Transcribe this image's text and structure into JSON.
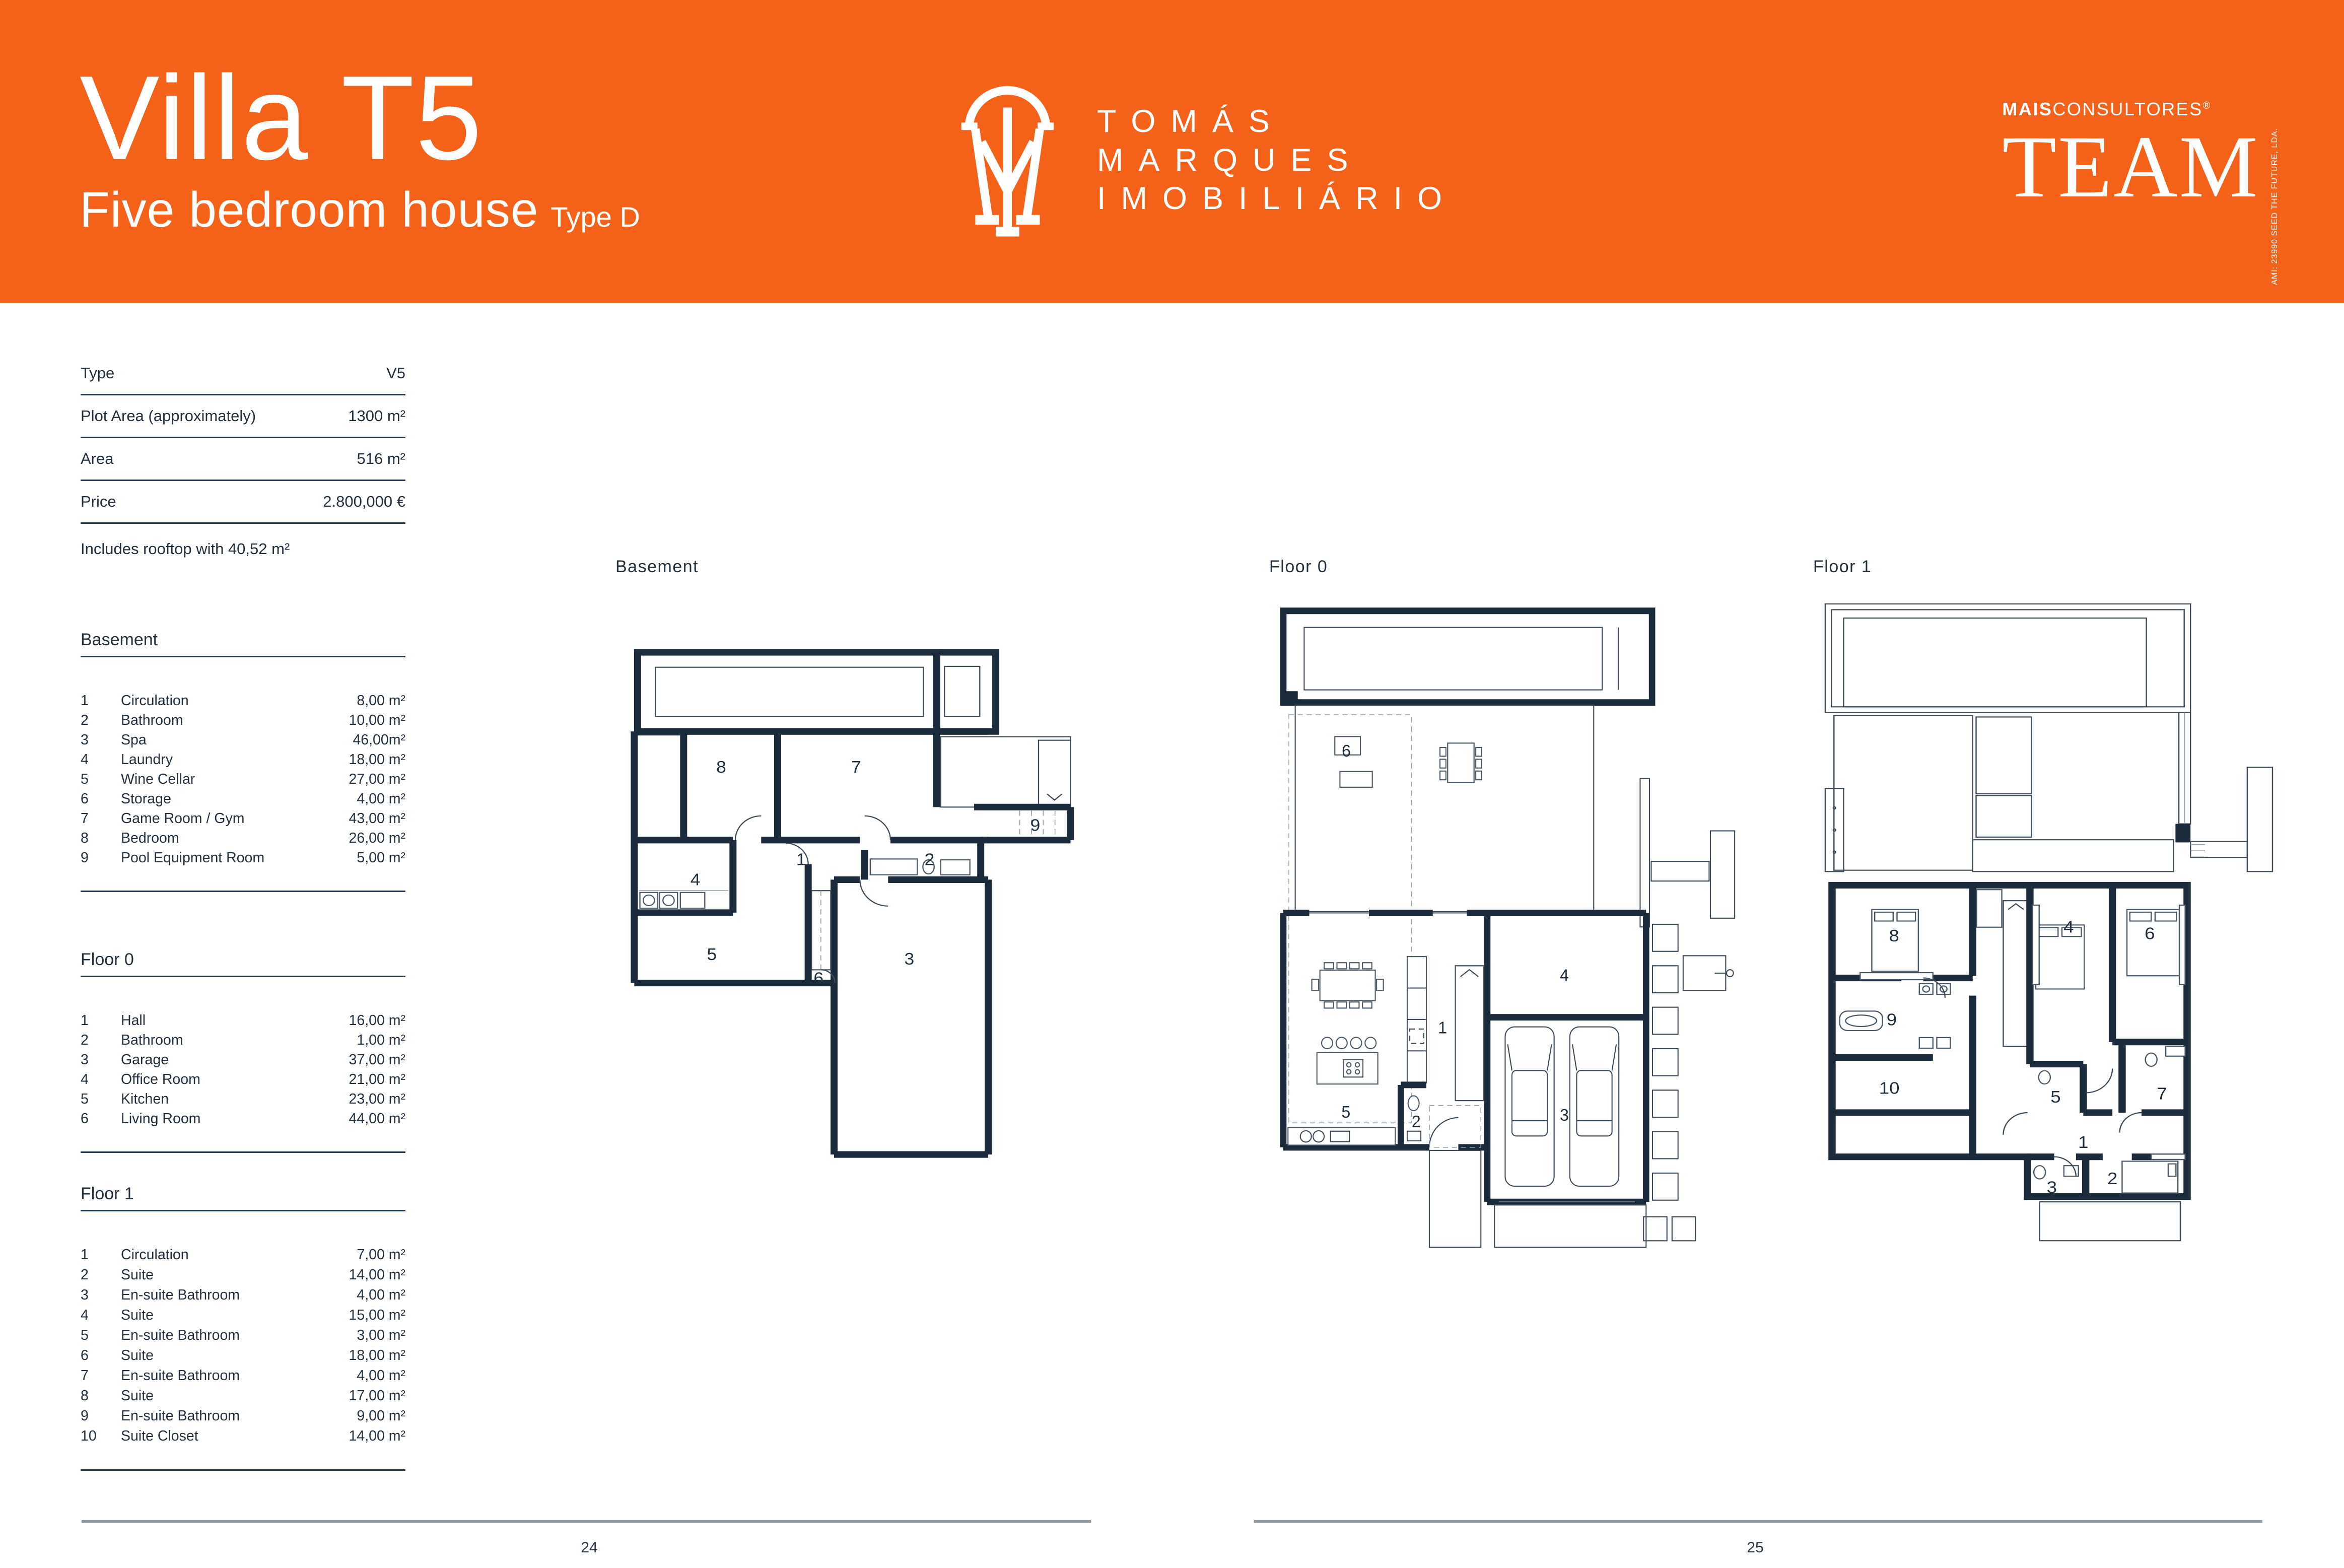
{
  "colors": {
    "orange": "#F4621A",
    "navy_text": "#22303E",
    "wall": "#1C2B3C",
    "footer_line": "#8E98A1"
  },
  "header": {
    "title": "Villa T5",
    "subtitle": "Five bedroom house",
    "type_label": "Type D",
    "brand": {
      "line1": "TOMÁS",
      "line2": "MARQUES",
      "line3": "IMOBILIÁRIO"
    },
    "team": {
      "bold": "MAIS",
      "rest": "CONSULTORES",
      "reg": "®",
      "main": "TEAM",
      "side": "AMI: 23990  SEED THE FUTURE, LDA."
    }
  },
  "specs": {
    "rows": [
      {
        "label": "Type",
        "value": "V5"
      },
      {
        "label": "Plot Area (approximately)",
        "value": "1300 m²"
      },
      {
        "label": "Area",
        "value": "516 m²"
      },
      {
        "label": "Price",
        "value": "2.800,000 €"
      }
    ]
  },
  "note": "Includes rooftop with 40,52 m²",
  "lists": [
    {
      "title": "Basement",
      "rooms": [
        {
          "no": "1",
          "name": "Circulation",
          "area": "8,00 m²"
        },
        {
          "no": "2",
          "name": "Bathroom",
          "area": "10,00 m²"
        },
        {
          "no": "3",
          "name": "Spa",
          "area": "46,00m²"
        },
        {
          "no": "4",
          "name": "Laundry",
          "area": "18,00 m²"
        },
        {
          "no": "5",
          "name": "Wine Cellar",
          "area": "27,00 m²"
        },
        {
          "no": "6",
          "name": "Storage",
          "area": "4,00 m²"
        },
        {
          "no": "7",
          "name": "Game Room / Gym",
          "area": "43,00 m²"
        },
        {
          "no": "8",
          "name": "Bedroom",
          "area": "26,00 m²"
        },
        {
          "no": "9",
          "name": "Pool Equipment Room",
          "area": "5,00 m²"
        }
      ]
    },
    {
      "title": "Floor 0",
      "rooms": [
        {
          "no": "1",
          "name": "Hall",
          "area": "16,00 m²"
        },
        {
          "no": "2",
          "name": "Bathroom",
          "area": "1,00 m²"
        },
        {
          "no": "3",
          "name": "Garage",
          "area": "37,00 m²"
        },
        {
          "no": "4",
          "name": "Office Room",
          "area": "21,00 m²"
        },
        {
          "no": "5",
          "name": "Kitchen",
          "area": "23,00 m²"
        },
        {
          "no": "6",
          "name": "Living Room",
          "area": "44,00 m²"
        }
      ]
    },
    {
      "title": "Floor 1",
      "rooms": [
        {
          "no": "1",
          "name": "Circulation",
          "area": "7,00 m²"
        },
        {
          "no": "2",
          "name": "Suite",
          "area": "14,00 m²"
        },
        {
          "no": "3",
          "name": "En-suite Bathroom",
          "area": "4,00 m²"
        },
        {
          "no": "4",
          "name": "Suite",
          "area": "15,00 m²"
        },
        {
          "no": "5",
          "name": "En-suite Bathroom",
          "area": "3,00 m²"
        },
        {
          "no": "6",
          "name": "Suite",
          "area": "18,00 m²"
        },
        {
          "no": "7",
          "name": "En-suite Bathroom",
          "area": "4,00 m²"
        },
        {
          "no": "8",
          "name": "Suite",
          "area": "17,00 m²"
        },
        {
          "no": "9",
          "name": "En-suite Bathroom",
          "area": "9,00 m²"
        },
        {
          "no": "10",
          "name": "Suite Closet",
          "area": "14,00 m²"
        }
      ]
    }
  ],
  "plans": {
    "basement": {
      "title": "Basement",
      "labels": [
        "8",
        "7",
        "9",
        "1",
        "2",
        "4",
        "5",
        "6",
        "3"
      ]
    },
    "floor0": {
      "title": "Floor 0",
      "labels": [
        "6",
        "4",
        "1",
        "5",
        "2",
        "3"
      ]
    },
    "floor1": {
      "title": "Floor 1",
      "labels": [
        "8",
        "4",
        "6",
        "9",
        "5",
        "7",
        "10",
        "1",
        "2",
        "3"
      ]
    }
  },
  "footer": {
    "left": "24",
    "right": "25"
  }
}
